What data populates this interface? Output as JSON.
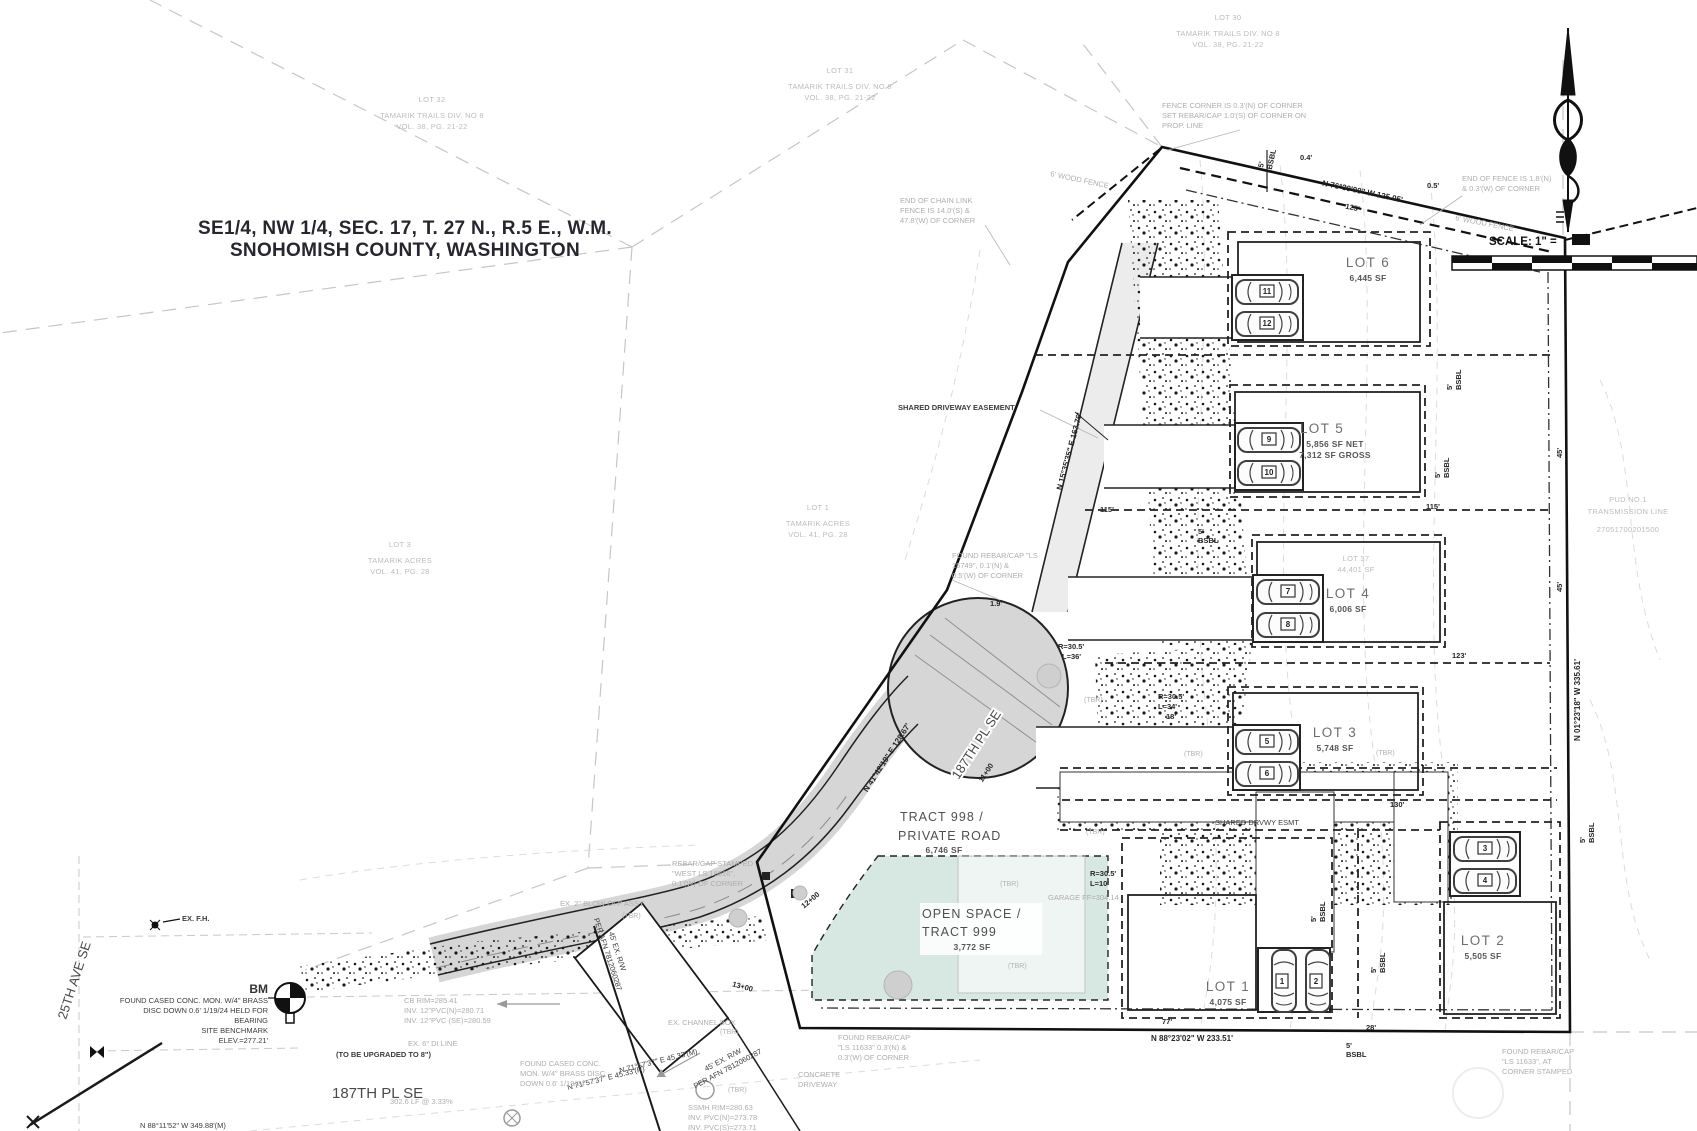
{
  "title": {
    "line1": "SE1/4, NW 1/4, SEC. 17, T. 27 N., R.5 E., W.M.",
    "line2": "SNOHOMISH COUNTY, WASHINGTON"
  },
  "scale_label": "SCALE: 1\" =",
  "colors": {
    "road_fill": "#d6d6d6",
    "open_space_fill": "#d7e7e1",
    "line": "#111111",
    "gray_note": "#aeaeae"
  },
  "lots": [
    {
      "name": "LOT 1",
      "area": "4,075 SF",
      "cars": [
        "1",
        "2"
      ]
    },
    {
      "name": "LOT 2",
      "area": "5,505 SF",
      "cars": [
        "3",
        "4"
      ]
    },
    {
      "name": "LOT 3",
      "area": "5,748 SF",
      "cars": [
        "5",
        "6"
      ]
    },
    {
      "name": "LOT 4",
      "area": "6,006 SF",
      "cars": [
        "7",
        "8"
      ]
    },
    {
      "name": "LOT 5",
      "area_net": "5,856 SF NET",
      "area_gross": "7,312 SF GROSS",
      "cars": [
        "9",
        "10"
      ]
    },
    {
      "name": "LOT 6",
      "area": "6,445 SF",
      "cars": [
        "11",
        "12"
      ]
    }
  ],
  "tracts": {
    "private_road": {
      "line1": "TRACT 998 /",
      "line2": "PRIVATE ROAD",
      "area": "6,746 SF"
    },
    "open_space": {
      "line1": "OPEN SPACE /",
      "line2": "TRACT 999",
      "area": "3,772 SF"
    }
  },
  "streets": {
    "ave25": "25TH AVE SE",
    "pl187_road": "187TH PL SE",
    "pl187_bottom": "187TH PL SE"
  },
  "benchmark": {
    "label": "BM",
    "lines": [
      "FOUND CASED CONC. MON. W/4\" BRASS",
      "DISC DOWN 0.6' 1/19/24 HELD FOR",
      "BEARING",
      "SITE BENCHMARK",
      "ELEV.=277.21'"
    ]
  },
  "adjacent": {
    "lot30": [
      "LOT 30",
      "TAMARIK TRAILS DIV. NO 8",
      "VOL. 38, PG. 21-22"
    ],
    "lot31": [
      "LOT 31",
      "TAMARIK TRAILS DIV. NO 8",
      "VOL. 38, PG. 21-22"
    ],
    "lot32": [
      "LOT 32",
      "TAMARIK TRAILS DIV. NO 8",
      "VOL. 38, PG. 21-22"
    ],
    "tam1": [
      "LOT 1",
      "TAMARIK ACRES",
      "VOL. 41, PG. 28"
    ],
    "tam3": [
      "LOT 3",
      "TAMARIK ACRES",
      "VOL. 41, PG. 28"
    ],
    "lot37": [
      "LOT 37",
      "44,401 SF"
    ],
    "pud": {
      "l1": "PUD NO.1",
      "l2": "TRANSMISSION LINE",
      "parcel": "27051700201500"
    }
  },
  "bearings": {
    "top": "N 76°30'00\" W  125.05'",
    "right": "N 01°23'18\" W  335.61'",
    "bottom": "N 88°23'02\" W  233.51'",
    "road": "N 41°42'19\" E  128.67'",
    "drive": "N 15°35'35\" E  163.76'",
    "b71a": "N 71°57'37\" E  45.33'(R)",
    "b71b": "N 71°57'37\" E  45.33'(M)"
  },
  "dims": {
    "d125": "125'",
    "d77": "77'",
    "d28": "28'",
    "d115": "115'",
    "d123": "123'",
    "d130": "130'",
    "d45": "45'",
    "d19": "1.9'",
    "d04": "0.4'",
    "d05": "0.5'",
    "d18": "18'",
    "bsbl5": "5'",
    "bsbl": "BSBL",
    "r305": "R=30.5'",
    "l34": "L=34'",
    "l10": "L=10'",
    "l36": "L=36'"
  },
  "stations": {
    "s11": "11+00",
    "s12": "12+00",
    "s13": "13+00"
  },
  "notes": {
    "fence_corner": [
      "FENCE CORNER IS 0.3'(N) OF CORNER",
      "SET REBAR/CAP 1.0'(S) OF CORNER ON",
      "PROP. LINE"
    ],
    "end_fence": [
      "END OF FENCE IS 1.8'(N)",
      "& 0.3'(W) OF CORNER"
    ],
    "chain_link": [
      "END OF CHAIN LINK",
      "FENCE IS 14.0'(S) &",
      "47.8'(W) OF CORNER"
    ],
    "rebar15749": [
      "FOUND REBAR/CAP \"LS",
      "15749\", 0.1'(N) &",
      "0.5'(W) OF CORNER"
    ],
    "rebar_west": [
      "REBAR/CAP STAMPED",
      "\"WEST LS 16816\",",
      "0.1'(W) OF CORNER"
    ],
    "blowoff": "EX. 2\" BLOW OFF ASSY",
    "channel": "EX. CHANNEL BOX",
    "di_line": "EX. 6\" DI LINE",
    "upgraded": "(TO BE UPGRADED TO 8\")",
    "cb": [
      "CB RIM=285.41",
      "INV. 12\"PVC(N)=280.71",
      "INV. 12\"PVC (SE)=280.59"
    ],
    "cased_mon": [
      "FOUND CASED CONC.",
      "MON. W/4\" BRASS DISC",
      "DOWN 0.6' 1/19/24"
    ],
    "ssmh": [
      "SSMH RIM=280.63",
      "INV. PVC(N)=273.78",
      "INV. PVC(S)=273.71"
    ],
    "rebar11633a": [
      "FOUND REBAR/CAP",
      "\"LS 11633\", AT",
      "CORNER STAMPED"
    ],
    "rebar11633b": [
      "FOUND REBAR/CAP",
      "\"LS 11633\" 0.3'(N) &",
      "0.3'(W) OF CORNER"
    ],
    "conc_drive": [
      "CONCRETE",
      "DRIVEWAY"
    ],
    "garage_ff": "GARAGE FF=304.14",
    "exfh": "EX. F.H.",
    "wood_fence": "6' WOOD FENCE",
    "shared_drive": "SHARED DRIVEWAY EASEMENT",
    "shared_drvwy2": "SHARED DRVWY ESMT",
    "tbr": "(TBR)",
    "rw1": "45' EX. R/W",
    "rw2": "PER AFN 7812060287",
    "grade": "302.6 LF @ 3.33%",
    "basis": "N 88°11'52\" W  349.88'(M)"
  }
}
